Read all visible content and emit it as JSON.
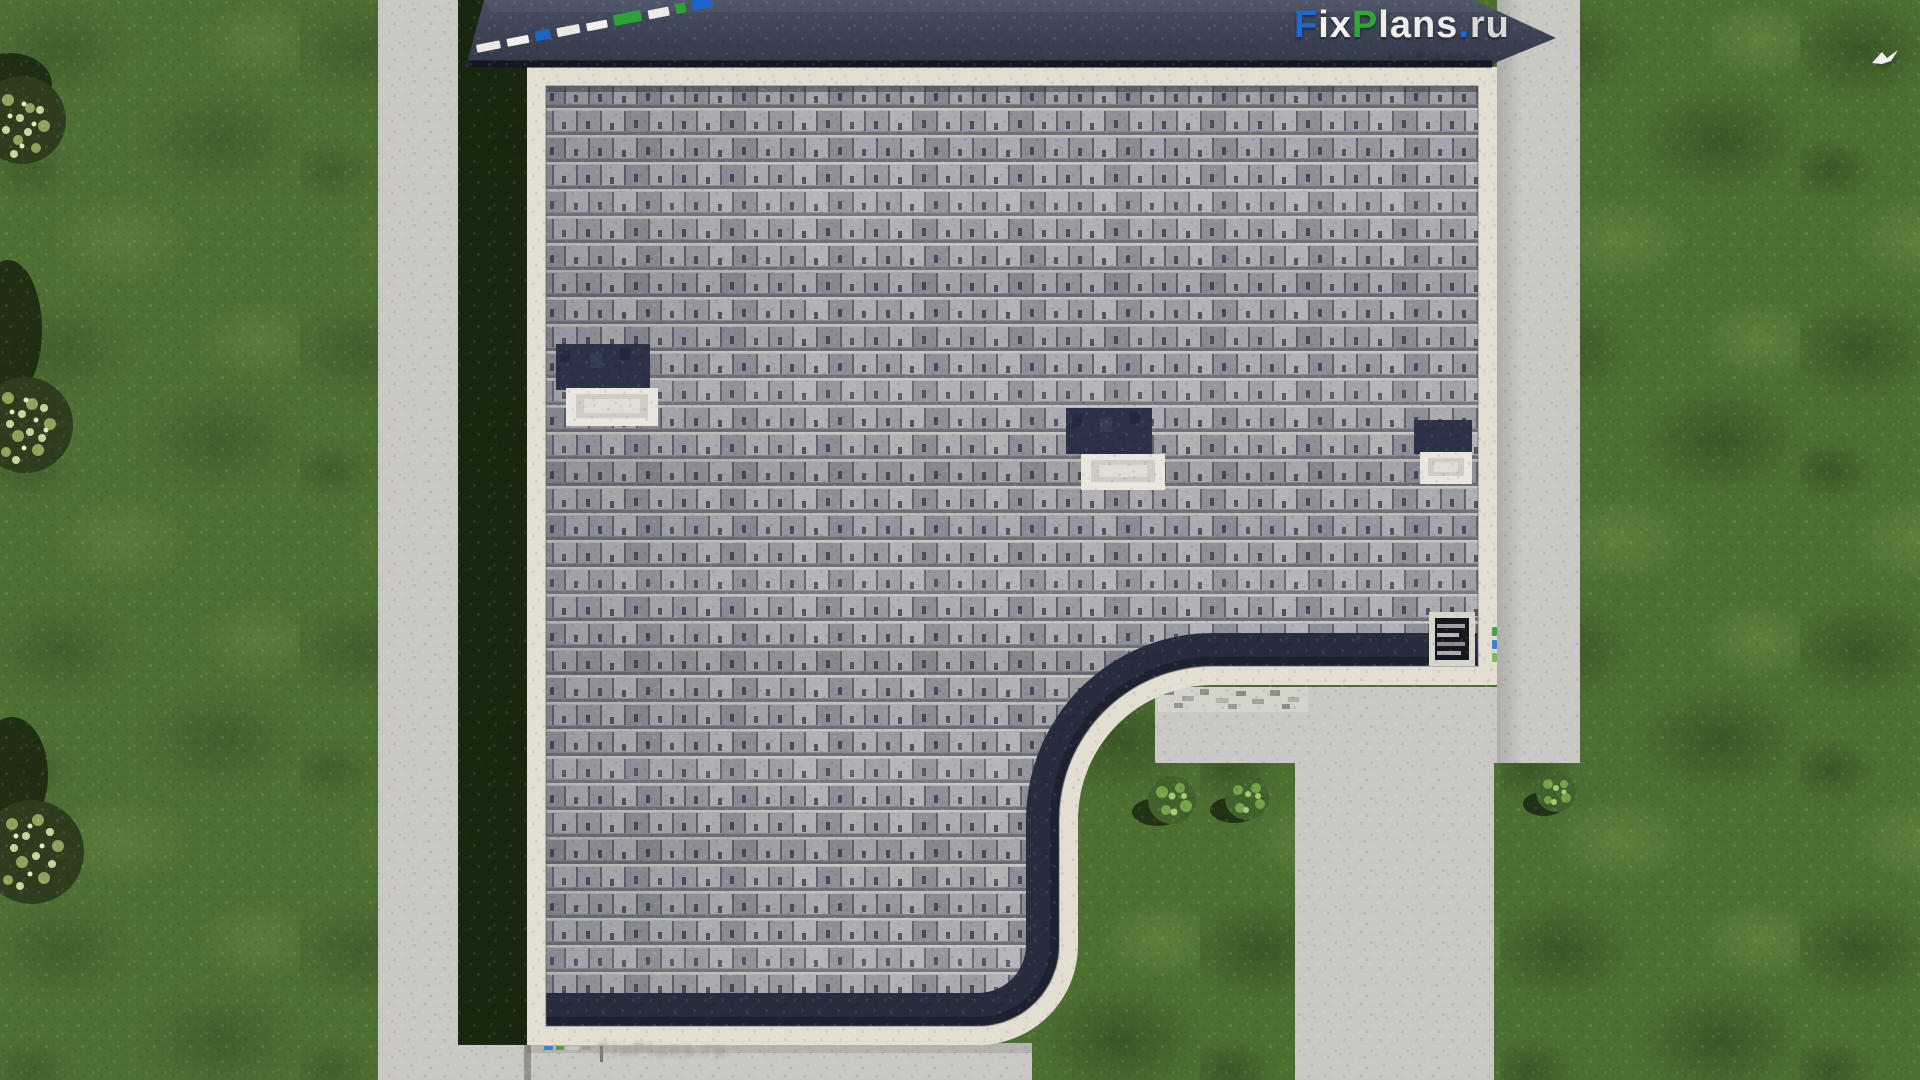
{
  "watermarks": {
    "logo_parts": [
      {
        "text": "F",
        "color": "#1b6ad5"
      },
      {
        "text": "ix",
        "color": "#f1f1ee"
      },
      {
        "text": "P",
        "color": "#2fa635"
      },
      {
        "text": "lans",
        "color": "#ededeb"
      },
      {
        "text": ".",
        "color": "#1b6ad5"
      },
      {
        "text": "ru",
        "color": "#d8d8d5"
      }
    ],
    "logo_shadow_text": "FixPlans.ru",
    "ground_text": "FixPlans.ru",
    "diagonal_blocks": [
      {
        "w": 24,
        "h": 8,
        "c": "#e8e8e6"
      },
      {
        "w": 22,
        "h": 8,
        "c": "#efefed"
      },
      {
        "w": 15,
        "h": 10,
        "c": "#1d64c8"
      },
      {
        "w": 23,
        "h": 9,
        "c": "#e8e8e6"
      },
      {
        "w": 21,
        "h": 8,
        "c": "#f0f0ee"
      },
      {
        "w": 28,
        "h": 11,
        "c": "#2da237"
      },
      {
        "w": 21,
        "h": 9,
        "c": "#eaeae8"
      },
      {
        "w": 10,
        "h": 10,
        "c": "#2da237"
      },
      {
        "w": 20,
        "h": 13,
        "c": "#1d64c8"
      }
    ],
    "ground_blocks": [
      {
        "w": 9,
        "h": 4,
        "c": "#3b82d4"
      },
      {
        "w": 8,
        "h": 4,
        "c": "#46a63e"
      },
      {
        "w": 12,
        "h": 4,
        "c": "#c6c6c2"
      },
      {
        "w": 9,
        "h": 4,
        "c": "#9c9c98"
      }
    ],
    "edge_blocks": [
      {
        "w": 5,
        "h": 9,
        "c": "#46a63e"
      },
      {
        "w": 5,
        "h": 9,
        "c": "#3b82d4"
      },
      {
        "w": 5,
        "h": 9,
        "c": "#7fb95e"
      }
    ]
  },
  "scene": {
    "description": "Aerial top-down 3D render of a house roof with grey asphalt shingles, dark eaves, three chimney caps, a louvered roof hatch, concrete walkways, lawn, shrubs, trees and a flying bird",
    "colors": {
      "grass": "#4d7032",
      "grass_shadow": "#16250f",
      "concrete": "#c9c8c4",
      "gravel": "#cfcdc8",
      "shingle": "#a4a4aa",
      "roof_border": "#e2ded2",
      "eave_dark": "#272d3f",
      "upper_wall": "#3e4557",
      "chimney_dark": "#2b3147",
      "chimney_cap": "#e9e6dd"
    }
  }
}
